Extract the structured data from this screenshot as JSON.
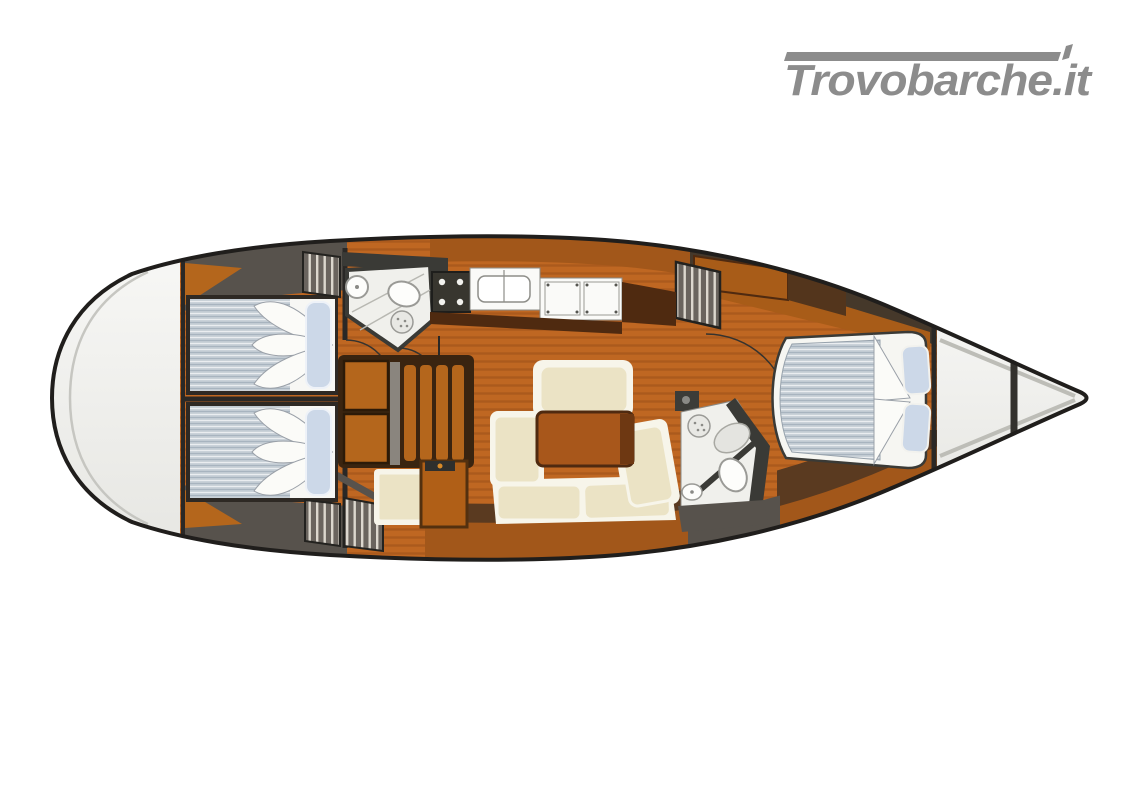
{
  "watermark": {
    "brand_text": "Trovobarche.it",
    "color": "#8c8c8c"
  },
  "floorplan": {
    "type": "sailboat-interior-deck-plan-top-view",
    "colors": {
      "outline": "#201e1c",
      "deck_white": "#f1f1ee",
      "wood_floor": "#bf6722",
      "wood_band": "#a2571a",
      "dark_wood": "#4f2a10",
      "brown_band": "#5a3a20",
      "gray_band": "#57524c",
      "locker_gray": "#6a645e",
      "mattress_gray_blue": "#c2cbd3",
      "pillow_blue": "#ccd8e8",
      "cushion_cream": "#ebe3c5",
      "cushion_border": "#f7f5ea",
      "fixture_white": "#f0f0ec",
      "table_brown": "#3a2410",
      "slat_orange": "#b4661c"
    },
    "elements": [
      "stern-deck",
      "aft-double-cabin-port",
      "aft-double-cabin-starboard",
      "aft-head-shower",
      "galley-stove",
      "galley-sink",
      "galley-lockers",
      "storage-locker-hatched",
      "saloon-drop-leaf-table",
      "l-shaped-settee",
      "saloon-bench",
      "nav-cabinet",
      "forward-head-shower",
      "forward-v-berth-cabin",
      "bow-anchor-locker"
    ]
  }
}
